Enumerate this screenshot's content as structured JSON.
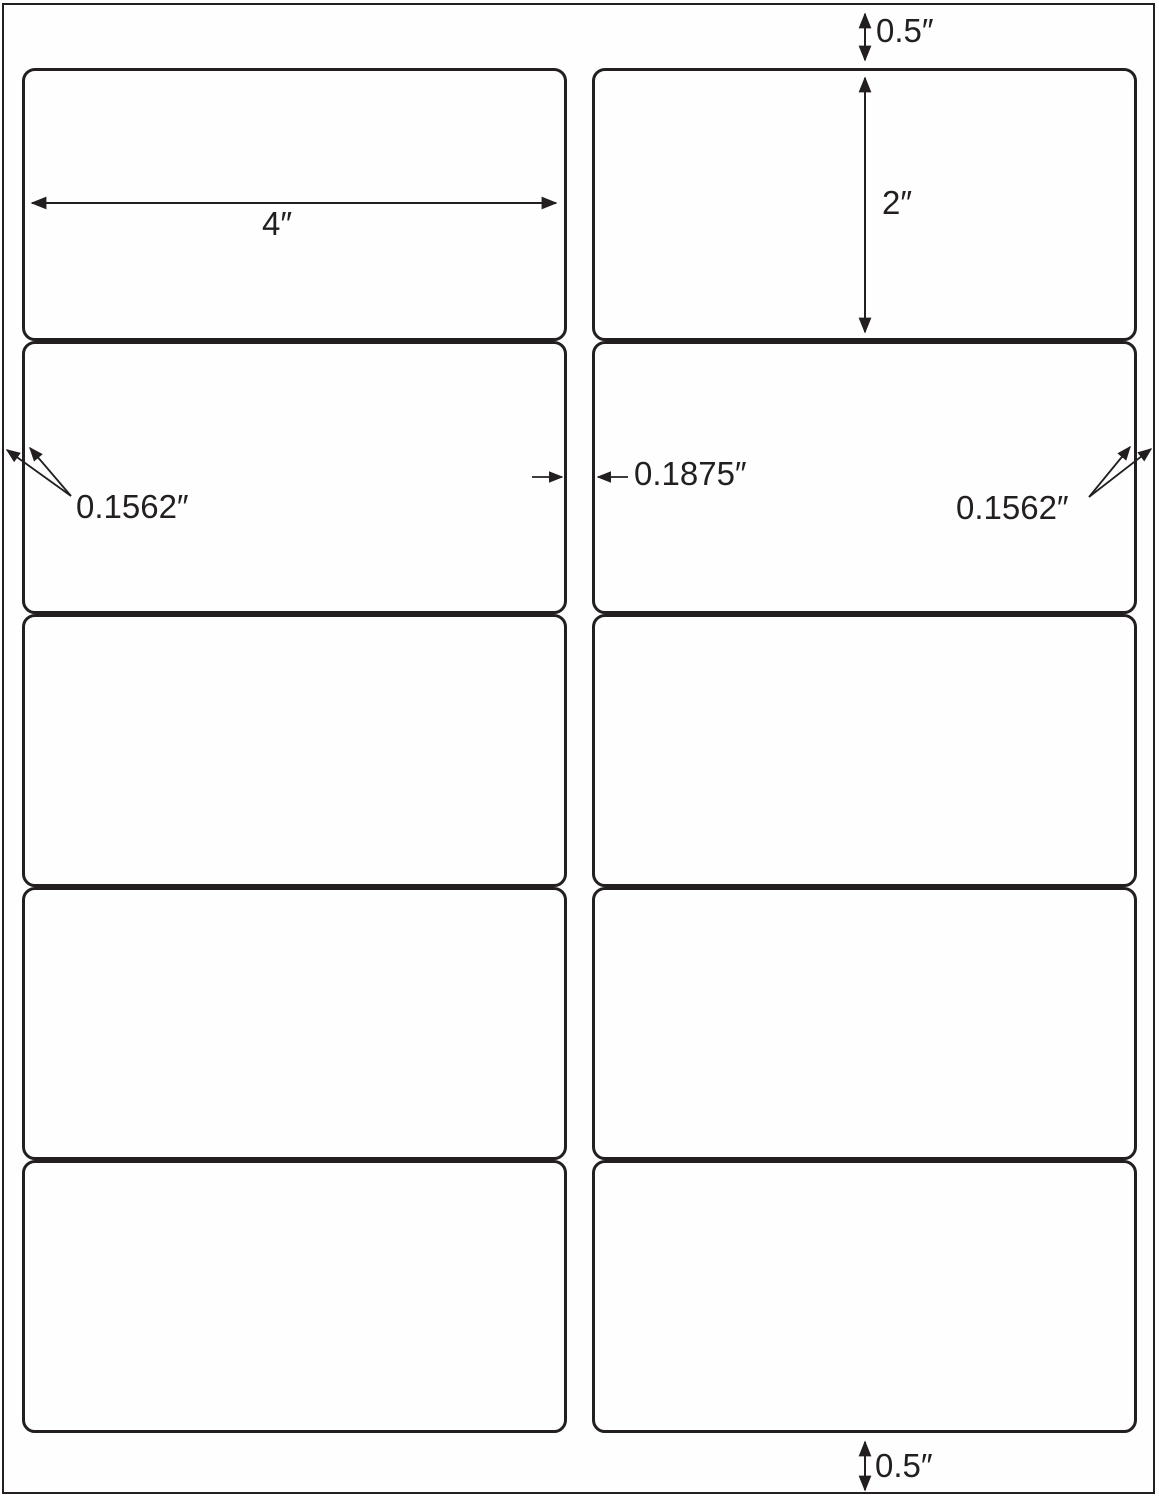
{
  "page": {
    "description": "Blank adhesive label sheet template diagram, 2 columns by 5 rows of rounded rectangle labels",
    "columns": 2,
    "rows": 5,
    "label_count": 10
  },
  "annotations": {
    "top_margin": "0.5″",
    "label_height": "2″",
    "label_width": "4″",
    "left_margin": "0.1562″",
    "center_gap": "0.1875″",
    "right_margin": "0.1562″",
    "bottom_margin": "0.5″"
  },
  "colors": {
    "line": "#231f20",
    "background": "#ffffff"
  }
}
